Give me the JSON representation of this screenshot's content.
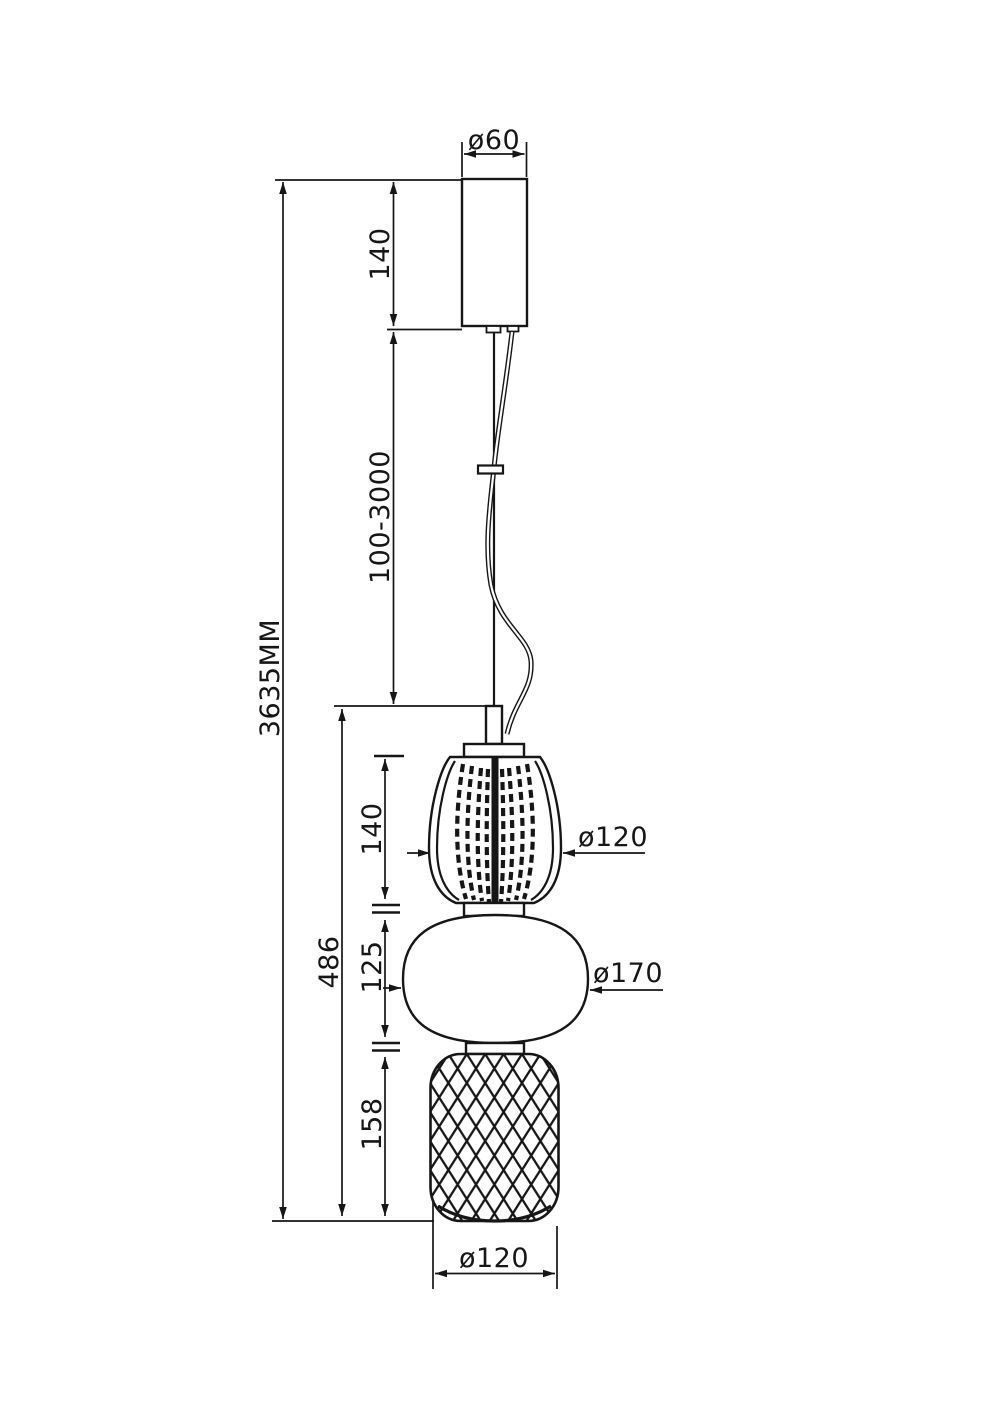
{
  "drawing": {
    "title": "Pendant lamp dimensional drawing",
    "units": "MM",
    "line_color": "#161616",
    "background_color": "#ffffff",
    "labels": {
      "canopy_diameter": "ø60",
      "canopy_height": "140",
      "suspension_length": "100-3000",
      "overall_height": "3635MM",
      "fixture_height": "486",
      "top_shade_height": "140",
      "top_shade_diameter": "ø120",
      "middle_shade_height": "125",
      "middle_shade_diameter": "ø170",
      "bottom_shade_height": "158",
      "bottom_shade_diameter": "ø120"
    }
  }
}
